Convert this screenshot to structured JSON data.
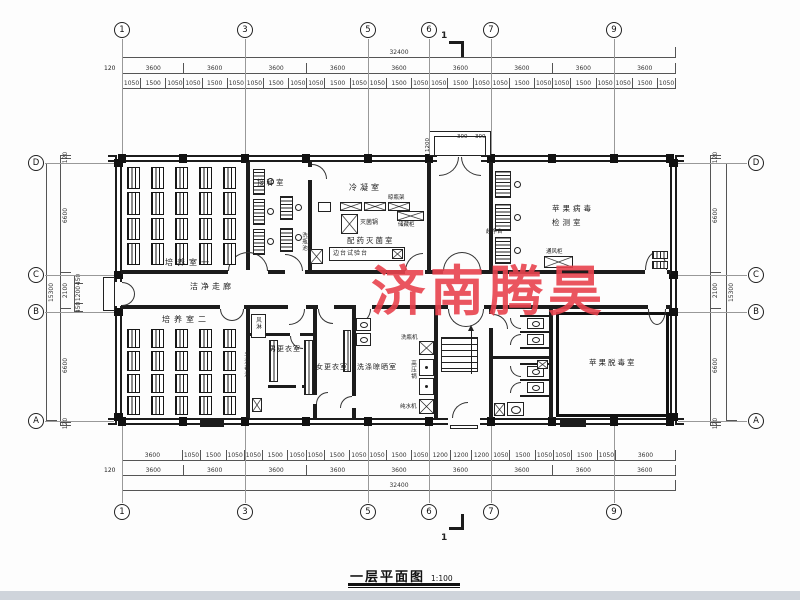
{
  "watermark": {
    "text": "济南腾昊",
    "color": "#e8434e"
  },
  "title": {
    "name": "一层平面图",
    "scale": "1:100"
  },
  "grid": {
    "top": [
      "1",
      "3",
      "5",
      "6",
      "7",
      "9"
    ],
    "bottom": [
      "1",
      "3",
      "5",
      "6",
      "7",
      "9"
    ],
    "left": [
      "D",
      "C",
      "B",
      "A"
    ],
    "right": [
      "D",
      "C",
      "B",
      "A"
    ]
  },
  "section_markers": {
    "top": "1",
    "bottom": "1"
  },
  "dimensions": {
    "top": {
      "overall": [
        "32400"
      ],
      "offset": "120",
      "bays": [
        "3600",
        "3600",
        "3600",
        "3600",
        "3600",
        "3600",
        "3600",
        "3600",
        "3600"
      ],
      "detail": [
        "1050",
        "1500",
        "1050",
        "1050",
        "1500",
        "1050",
        "1050",
        "1500",
        "1050",
        "1050",
        "1500",
        "1050",
        "1050",
        "1500",
        "1050",
        "1050",
        "1500",
        "1050",
        "1050",
        "1500",
        "1050",
        "1050",
        "1500",
        "1050",
        "1050",
        "1500",
        "1050"
      ]
    },
    "bottom": {
      "overall": [
        "32400"
      ],
      "offset": "120",
      "bays": [
        "3600",
        "3600",
        "3600",
        "3600",
        "3600",
        "3600",
        "3600",
        "3600",
        "3600"
      ],
      "detail": [
        "3600",
        "1050",
        "1500",
        "1050",
        "1050",
        "1500",
        "1050",
        "1050",
        "1500",
        "1050",
        "1050",
        "1500",
        "1050",
        "1200",
        "1200",
        "1200",
        "1050",
        "1500",
        "1050",
        "1050",
        "1500",
        "1050",
        "3600"
      ]
    },
    "left": {
      "overall": [
        "15300"
      ],
      "chain": [
        "120",
        "6600",
        "2100",
        "6600",
        "120"
      ],
      "sub": [
        "450",
        "1200",
        "450"
      ]
    },
    "right": {
      "overall": [
        "15300"
      ],
      "chain": [
        "120",
        "6600",
        "2100",
        "6600",
        "120"
      ]
    },
    "entrance": {
      "depth": "1200",
      "w1": "300",
      "w2": "300"
    }
  },
  "rooms": {
    "culture1": "培养室一",
    "inoculation": "接种室",
    "condensation": "冷凝室",
    "dispensing": "配药灭菌室",
    "corridor": "洁净走廊",
    "culture2": "培养室二",
    "men_changing": "男更衣室",
    "women_changing": "女更衣室",
    "washing": "洗涤晾晒室",
    "virus_test_line1": "苹果病毒",
    "virus_test_line2": "检测室",
    "detox": "苹果脱毒室"
  },
  "equipment": {
    "air_shower": "风淋",
    "sterilizer": "灭菌锅",
    "bottle_rack": "晾瓶架",
    "storage_cabinet": "储藏柜",
    "side_bench": "边台试验台",
    "wash_sink": "洗瓶池",
    "clean_bench": "超净台",
    "fume_hood": "通风柜",
    "bottle_washer": "洗瓶机",
    "autoclave": "高压锅",
    "water_purifier": "纯水机",
    "hand_sanitize": "手消毒池"
  }
}
